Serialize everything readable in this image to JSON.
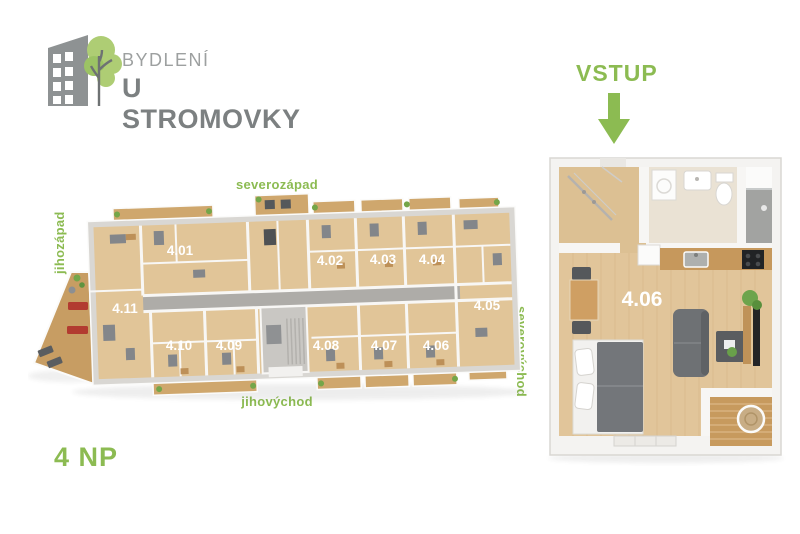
{
  "brand": {
    "line1": "BYDLENÍ",
    "line2": "U STROMOVKY"
  },
  "entrance": {
    "label": "VSTUP"
  },
  "floor": {
    "label": "4 NP"
  },
  "compass": {
    "top": "severozápad",
    "left": "jihozápad",
    "bottom": "jihovýchod",
    "right": "severovýchod"
  },
  "overview": {
    "apartments": [
      {
        "label": "4.01",
        "x": 152,
        "y": 82
      },
      {
        "label": "4.02",
        "x": 302,
        "y": 92
      },
      {
        "label": "4.03",
        "x": 355,
        "y": 91
      },
      {
        "label": "4.04",
        "x": 404,
        "y": 91
      },
      {
        "label": "4.05",
        "x": 459,
        "y": 137
      },
      {
        "label": "4.06",
        "x": 408,
        "y": 177
      },
      {
        "label": "4.07",
        "x": 356,
        "y": 177
      },
      {
        "label": "4.08",
        "x": 298,
        "y": 177
      },
      {
        "label": "4.09",
        "x": 201,
        "y": 177
      },
      {
        "label": "4.10",
        "x": 151,
        "y": 177
      },
      {
        "label": "4.11",
        "x": 97,
        "y": 140
      }
    ]
  },
  "detail": {
    "label": "4.06"
  },
  "colors": {
    "accent_green": "#8cbb52",
    "logo_grey_light": "#9da0a0",
    "logo_grey_dark": "#7c8081",
    "wood_light": "#e1c598",
    "wood_dark": "#c79a5e",
    "wall_grey": "#d9d7d3",
    "lounger_red": "#b23b30"
  }
}
